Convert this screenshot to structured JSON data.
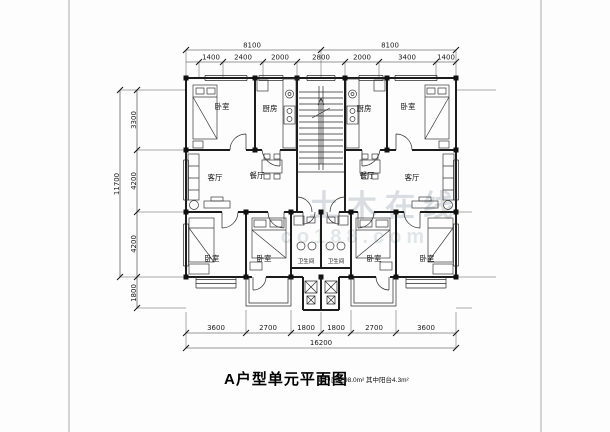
{
  "meta": {
    "title": "A户型单元平面图",
    "subtitle": "每户面积98.0m² 其中阳台4.3m²"
  },
  "watermark": {
    "main": "土木在线",
    "sub": "co188.com"
  },
  "dims": {
    "top_total_left": "8100",
    "top_total_right": "8100",
    "top": [
      "1400",
      "2400",
      "2000",
      "2800",
      "2000",
      "3400",
      "1400"
    ],
    "left_total": "11700",
    "left": [
      "3300",
      "4200",
      "4200",
      "1800"
    ],
    "bottom": [
      "3600",
      "2700",
      "1800",
      "1800",
      "2700",
      "3600"
    ],
    "bottom_total": "16200"
  },
  "rooms": [
    {
      "label": "卧室"
    },
    {
      "label": "厨房"
    },
    {
      "label": "厨房"
    },
    {
      "label": "卧室"
    },
    {
      "label": "客厅"
    },
    {
      "label": "餐厅"
    },
    {
      "label": "餐厅"
    },
    {
      "label": "客厅"
    },
    {
      "label": "卧室"
    },
    {
      "label": "卧室"
    },
    {
      "label": "卫生间"
    },
    {
      "label": "卫生间"
    },
    {
      "label": "卧室"
    },
    {
      "label": "卧室"
    }
  ]
}
